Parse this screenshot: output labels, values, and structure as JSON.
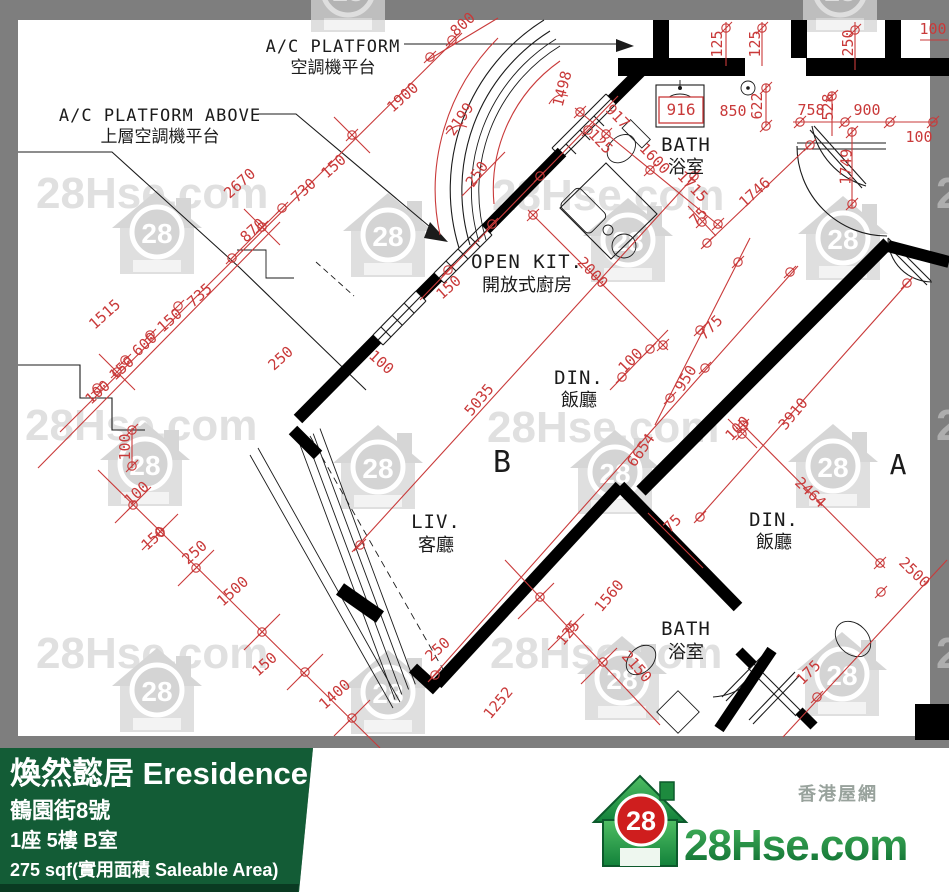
{
  "watermark": {
    "text": "28Hse.com",
    "badge": "28"
  },
  "plan": {
    "labels": {
      "ac_platform": {
        "en": "A/C PLATFORM",
        "zh": "空調機平台"
      },
      "ac_platform_above": {
        "en": "A/C PLATFORM ABOVE",
        "zh": "上層空調機平台"
      },
      "open_kitchen": {
        "en": "OPEN KIT.",
        "zh": "開放式廚房"
      },
      "bath_top": {
        "en": "BATH",
        "zh": "浴室"
      },
      "dining_b": {
        "en": "DIN.",
        "zh": "飯廳"
      },
      "living": {
        "en": "LIV.",
        "zh": "客廳"
      },
      "dining_a": {
        "en": "DIN.",
        "zh": "飯廳"
      },
      "bath_bottom": {
        "en": "BATH",
        "zh": "浴室"
      },
      "unit_b": "B",
      "unit_a": "A"
    },
    "dimensions": [
      "1515",
      "100",
      "150",
      "600",
      "150",
      "735",
      "870",
      "2670",
      "730",
      "150",
      "1900",
      "800",
      "2199",
      "1498",
      "250",
      "150",
      "100",
      "250",
      "100",
      "100",
      "150",
      "250",
      "1500",
      "150",
      "1400",
      "250",
      "5035",
      "2000",
      "100",
      "950",
      "775",
      "6654",
      "100",
      "3910",
      "2464",
      "2500",
      "175",
      "75",
      "1560",
      "125",
      "1252",
      "2150",
      "1746",
      "1749",
      "1715",
      "1600",
      "125",
      "917",
      "75",
      "916",
      "850",
      "622",
      "125",
      "125",
      "250",
      "528",
      "758",
      "900",
      "100",
      "100"
    ]
  },
  "footer": {
    "estate": "煥然懿居 Eresidence",
    "address": "鶴園街8號",
    "unit": "1座 5樓 B室",
    "area": "275 sqf(實用面積 Saleable Area)",
    "site_name": "香港屋網",
    "logo_text": "28Hse.com",
    "logo_badge": "28"
  }
}
